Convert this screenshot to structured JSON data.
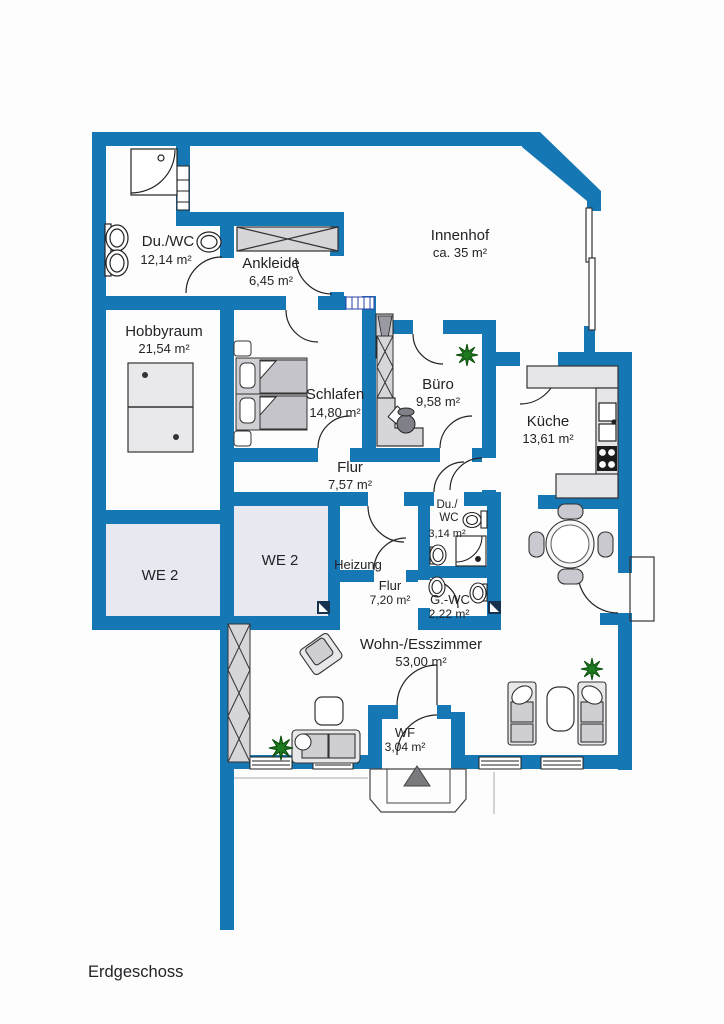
{
  "plan": {
    "floor_label": "Erdgeschoss",
    "colors": {
      "wall": "#1677b5",
      "we2_fill": "#e8e8f1",
      "furniture": "#d6d6da",
      "plant": "#1e7a1e"
    },
    "rooms": [
      {
        "name": "Du./WC",
        "area": "12,14 m²"
      },
      {
        "name": "Ankleide",
        "area": "6,45 m²"
      },
      {
        "name": "Innenhof",
        "area": "ca. 35 m²"
      },
      {
        "name": "Hobbyraum",
        "area": "21,54 m²"
      },
      {
        "name": "Schlafen",
        "area": "14,80 m²"
      },
      {
        "name": "Büro",
        "area": "9,58 m²"
      },
      {
        "name": "Küche",
        "area": "13,61 m²"
      },
      {
        "name": "Flur",
        "area": "7,57 m²"
      },
      {
        "name": "WE 2"
      },
      {
        "name": "WE 2"
      },
      {
        "name": "Heizung"
      },
      {
        "name_line1": "Du./",
        "name_line2": "WC",
        "area": "3,14 m²"
      },
      {
        "name": "Flur",
        "area": "7,20 m²"
      },
      {
        "name": "G.-WC",
        "area": "2,22 m²"
      },
      {
        "name": "Wohn-/Esszimmer",
        "area": "53,00 m²"
      },
      {
        "name": "WF",
        "area": "3,04 m²"
      }
    ]
  }
}
